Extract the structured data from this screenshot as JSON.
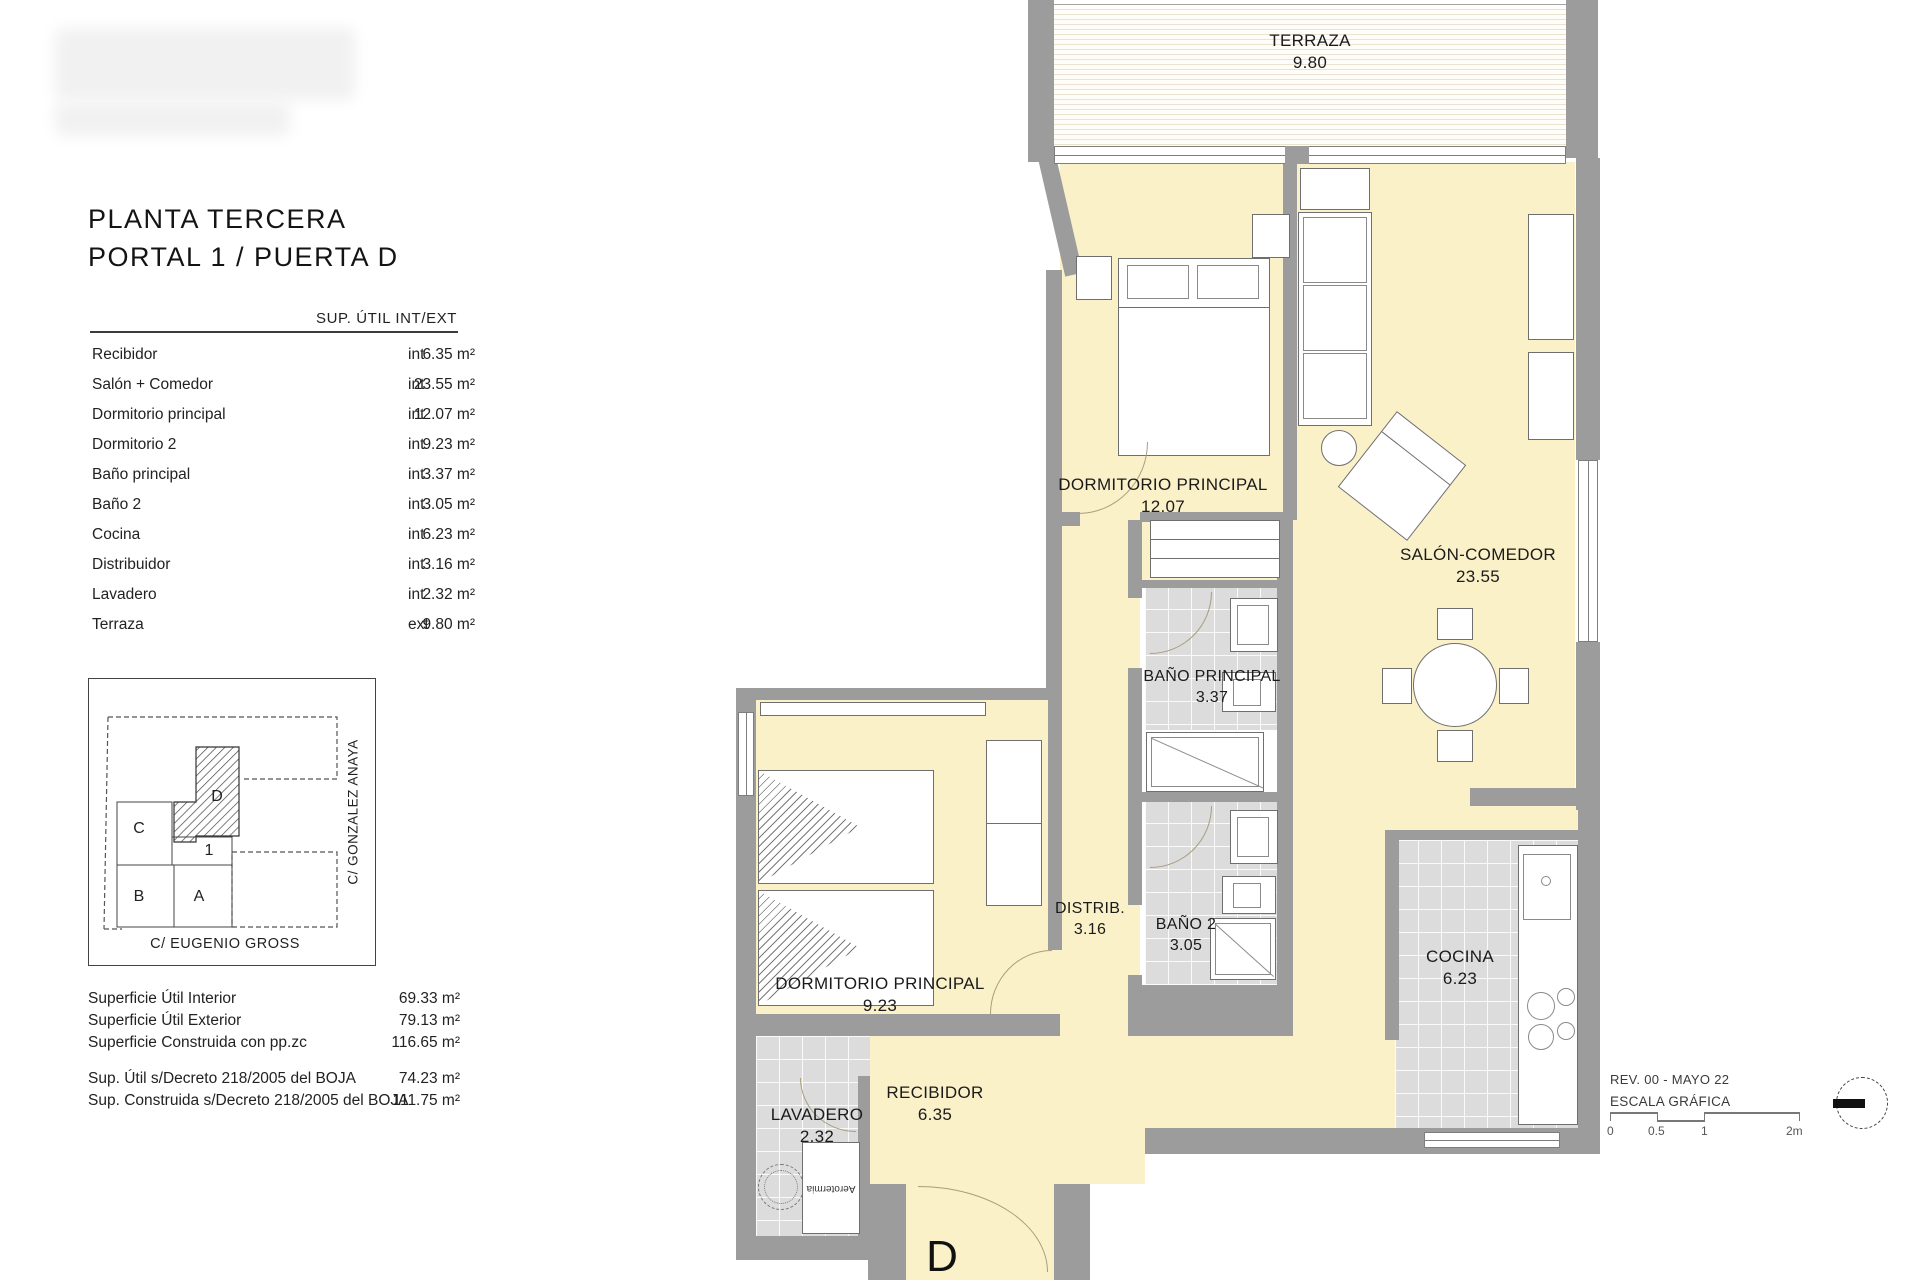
{
  "sheet": {
    "title_line1": "PLANTA TERCERA",
    "title_line2": "PORTAL 1 / PUERTA D"
  },
  "area_table": {
    "header": "SUP. ÚTIL INT/EXT",
    "rows": [
      {
        "name": "Recibidor",
        "value": "6.35 m²",
        "type": "int"
      },
      {
        "name": "Salón + Comedor",
        "value": "23.55 m²",
        "type": "int"
      },
      {
        "name": "Dormitorio principal",
        "value": "12.07 m²",
        "type": "int"
      },
      {
        "name": "Dormitorio 2",
        "value": "9.23 m²",
        "type": "int"
      },
      {
        "name": "Baño principal",
        "value": "3.37 m²",
        "type": "int"
      },
      {
        "name": "Baño 2",
        "value": "3.05 m²",
        "type": "int"
      },
      {
        "name": "Cocina",
        "value": "6.23 m²",
        "type": "int"
      },
      {
        "name": "Distribuidor",
        "value": "3.16 m²",
        "type": "int"
      },
      {
        "name": "Lavadero",
        "value": "2.32 m²",
        "type": "int"
      },
      {
        "name": "Terraza",
        "value": "9.80 m²",
        "type": "ext"
      }
    ]
  },
  "location_map": {
    "unit_c": "C",
    "unit_b": "B",
    "unit_a": "A",
    "unit_1": "1",
    "unit_d": "D",
    "street_right": "C/ GONZALEZ ANAYA",
    "street_bottom": "C/ EUGENIO GROSS"
  },
  "summary": {
    "row1_label": "Superficie Útil Interior",
    "row1_value": "69.33 m²",
    "row2_label": "Superficie Útil Exterior",
    "row2_value": "79.13 m²",
    "row3_label": "Superficie Construida con pp.zc",
    "row3_value": "116.65 m²",
    "row4_label": "Sup. Útil s/Decreto 218/2005 del BOJA",
    "row4_value": "74.23 m²",
    "row5_label": "Sup. Construida s/Decreto 218/2005 del BOJA",
    "row5_value": "111.75 m²"
  },
  "plan": {
    "terraza_label": "TERRAZA",
    "terraza_area": "9.80",
    "dorm_principal_label": "DORMITORIO PRINCIPAL",
    "dorm_principal_area": "12.07",
    "salon_label": "SALÓN-COMEDOR",
    "salon_area": "23.55",
    "bano_principal_label": "BAÑO PRINCIPAL",
    "bano_principal_area": "3.37",
    "distrib_label": "DISTRIB.",
    "distrib_area": "3.16",
    "bano2_label": "BAÑO 2",
    "bano2_area": "3.05",
    "dorm2_label": "DORMITORIO PRINCIPAL",
    "dorm2_area": "9.23",
    "cocina_label": "COCINA",
    "cocina_area": "6.23",
    "recibidor_label": "RECIBIDOR",
    "recibidor_area": "6.35",
    "lavadero_label": "LAVADERO",
    "lavadero_area": "2.32",
    "entry_door_label": "D",
    "aerotermia_label": "Aerotermia"
  },
  "footer": {
    "revision": "REV. 00 - MAYO 22",
    "scale_title": "ESCALA GRÁFICA",
    "tick_0": "0",
    "tick_05": "0.5",
    "tick_1": "1",
    "tick_2": "2m"
  },
  "colors": {
    "room_fill": "#faf1c9",
    "wall": "#9c9c9c",
    "tile": "#dcdcdc"
  }
}
